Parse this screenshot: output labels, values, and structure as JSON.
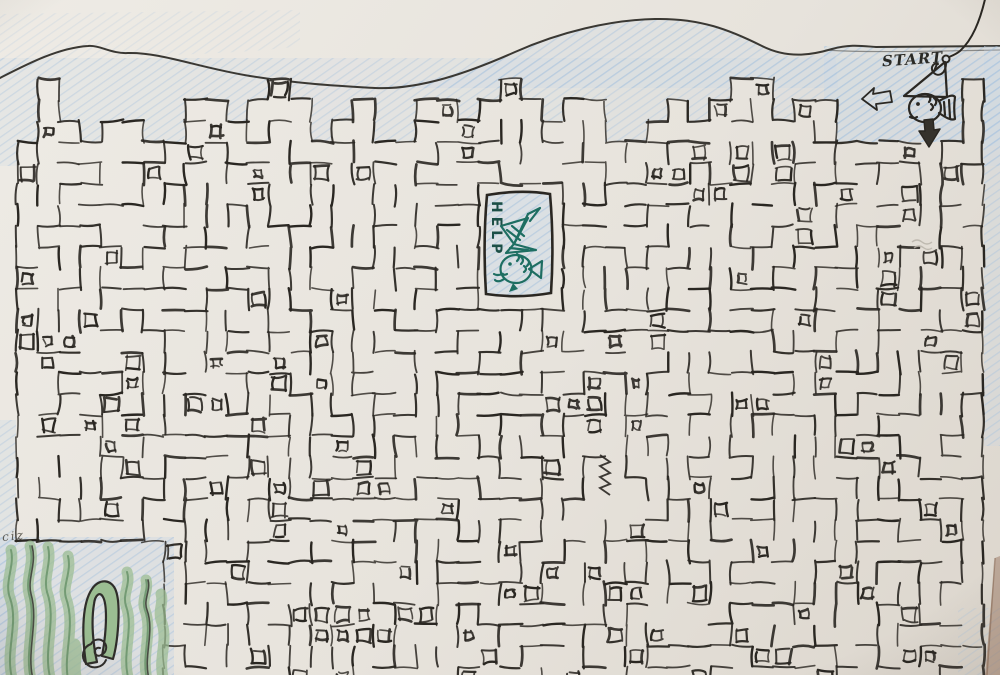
{
  "labels": {
    "start": "START",
    "help": "HELP",
    "corner_scribble": "ciz"
  },
  "colors": {
    "paper_light": "#eeebe5",
    "paper_mid": "#e7e3dc",
    "paper_dark": "#d9d3ca",
    "ink": "#2a2722",
    "mountain_line": "#3a3833",
    "pencil_blue": "#a9c3dd",
    "pencil_blue_tint": "#c9d9e8",
    "seaweed_fill": "#9bbd92",
    "seaweed_line": "#5d8a5f",
    "seaweed_ink": "#2f2d2a",
    "teal_fish": "#1e6e62",
    "help_text": "#1c4f46",
    "photo_edge_brown": "#8a5f45"
  },
  "maze": {
    "seed": 1337,
    "cols": 46,
    "rows": 30,
    "cell": 21,
    "x0": 17,
    "y0": 58,
    "extra_wall_removal": 0.1,
    "inner_rect_chance": 0.13,
    "entrance_x": 930,
    "help_room": {
      "x": 482,
      "y": 191,
      "w": 74,
      "h": 108
    },
    "seaweed_zone": {
      "max_x": 174,
      "min_y": 536
    }
  }
}
